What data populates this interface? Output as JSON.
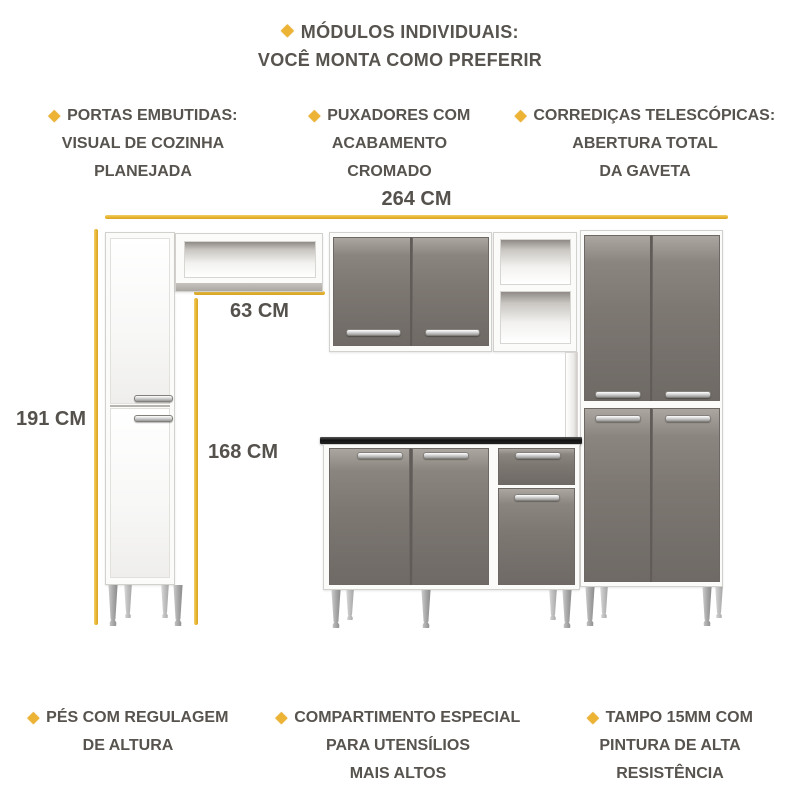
{
  "icons": {
    "bullet": "diamond-icon",
    "bullet_glyph": "◆"
  },
  "colors": {
    "accent_gold": "#e7b52f",
    "text_gray": "#57534e",
    "door_gray": "#7d7872",
    "carcass_white": "#fbfbfa",
    "countertop_black": "#1a1a1a",
    "handle_silver": "#c9c9c9"
  },
  "title": {
    "line1": "MÓDULOS INDIVIDUAIS:",
    "line2": "VOCÊ MONTA COMO PREFERIR"
  },
  "features_top": [
    {
      "lines": [
        "PORTAS EMBUTIDAS:",
        "VISUAL DE COZINHA",
        "PLANEJADA"
      ]
    },
    {
      "lines": [
        "PUXADORES COM",
        "ACABAMENTO",
        "CROMADO"
      ]
    },
    {
      "lines": [
        "CORREDIÇAS TELESCÓPICAS:",
        "ABERTURA TOTAL",
        "DA GAVETA"
      ]
    }
  ],
  "features_bottom": [
    {
      "lines": [
        "PÉS COM REGULAGEM",
        "DE ALTURA"
      ]
    },
    {
      "lines": [
        "COMPARTIMENTO ESPECIAL",
        "PARA UTENSÍLIOS",
        "MAIS ALTOS"
      ]
    },
    {
      "lines": [
        "TAMPO 15MM COM",
        "PINTURA DE ALTA",
        "RESISTÊNCIA"
      ]
    }
  ],
  "dimensions": {
    "total_width": "264 CM",
    "niche_width": "63 CM",
    "total_height": "191 CM",
    "inner_height": "168 CM"
  }
}
